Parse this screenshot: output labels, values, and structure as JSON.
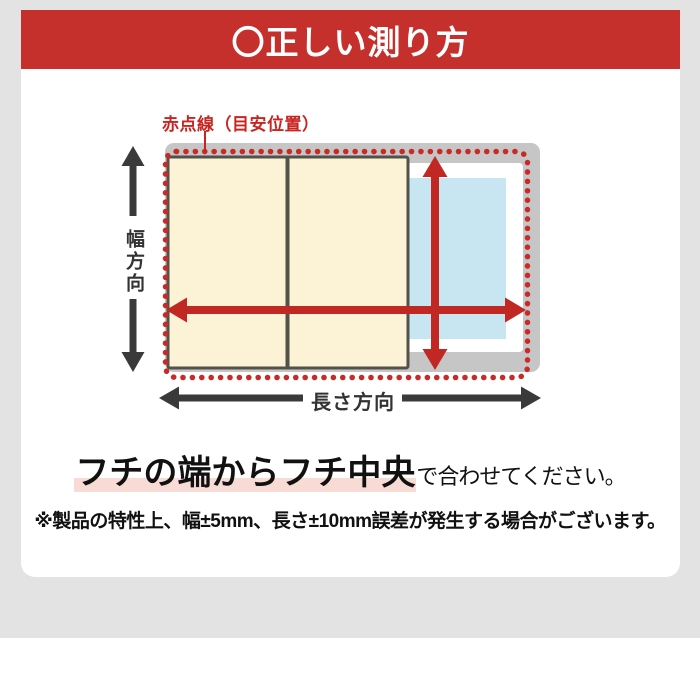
{
  "colors": {
    "page-gray": "#e3e3e3",
    "banner-red": "#c5302c",
    "rim-gray": "#c6c6c6",
    "water-blue": "#c8e6f1",
    "lid-cream": "#fcf2d6",
    "lid-border": "#52524a",
    "arrow-red": "#c22823",
    "dot-red": "#ca2a25",
    "label-red": "#c82421",
    "axis-dark": "#3a3a3a",
    "highlight-pink": "#f8dbd4"
  },
  "banner": {
    "title": "〇正しい測り方"
  },
  "diagram": {
    "guide_label": "赤点線（目安位置）",
    "width_label": "幅方向",
    "length_label": "長さ方向"
  },
  "caption": {
    "highlight_text": "フチの端からフチ中央",
    "suffix_text": "で合わせてください。"
  },
  "note": {
    "text": "※製品の特性上、幅±5mm、長さ±10mm誤差が発生する場合がございます。"
  }
}
